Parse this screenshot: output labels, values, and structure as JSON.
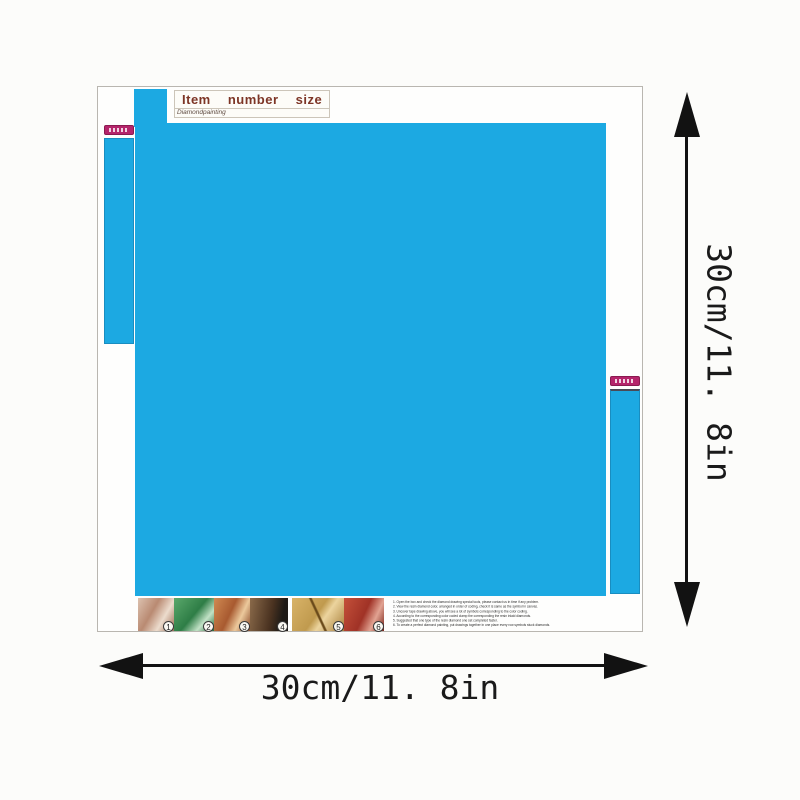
{
  "sheet": {
    "label": {
      "title": "Item number size",
      "subtitle": "Diamondpainting",
      "title_color": "#7d3526"
    },
    "canvas_color": "#1ca9e2",
    "brand_tag_color": "#b5256b"
  },
  "dimensions": {
    "width_label": "30cm/11. 8in",
    "height_label": "30cm/11. 8in"
  },
  "instructions": {
    "steps": [
      {
        "number": "1",
        "name": "open-box-check-tools"
      },
      {
        "number": "2",
        "name": "view-diamond-colors"
      },
      {
        "number": "3",
        "name": "uncover-tape"
      },
      {
        "number": "4",
        "name": "pick-up-diamonds"
      },
      {
        "number": "5",
        "name": "place-diamonds-on-canvas"
      },
      {
        "number": "6",
        "name": "press-to-finish"
      }
    ],
    "text_lines": [
      "1. Open the box and check the diamond drawing special tools, please contact us in time if any problem.",
      "2. View the resin diamond color, arranged in order of coding, check it is same as the symbol in canvas.",
      "3. Uncover tape drawing above, you will see a lot of symbols corresponding to the color coding.",
      "4. According to the corresponding color coded clamp the corresponding the resin inlaid diamonds.",
      "5. Suggested that one type of the resin diamond one set completed faster.",
      "6. To create a perfect diamond painting, put drawings together in one place every row symbols stuck diamonds."
    ]
  }
}
